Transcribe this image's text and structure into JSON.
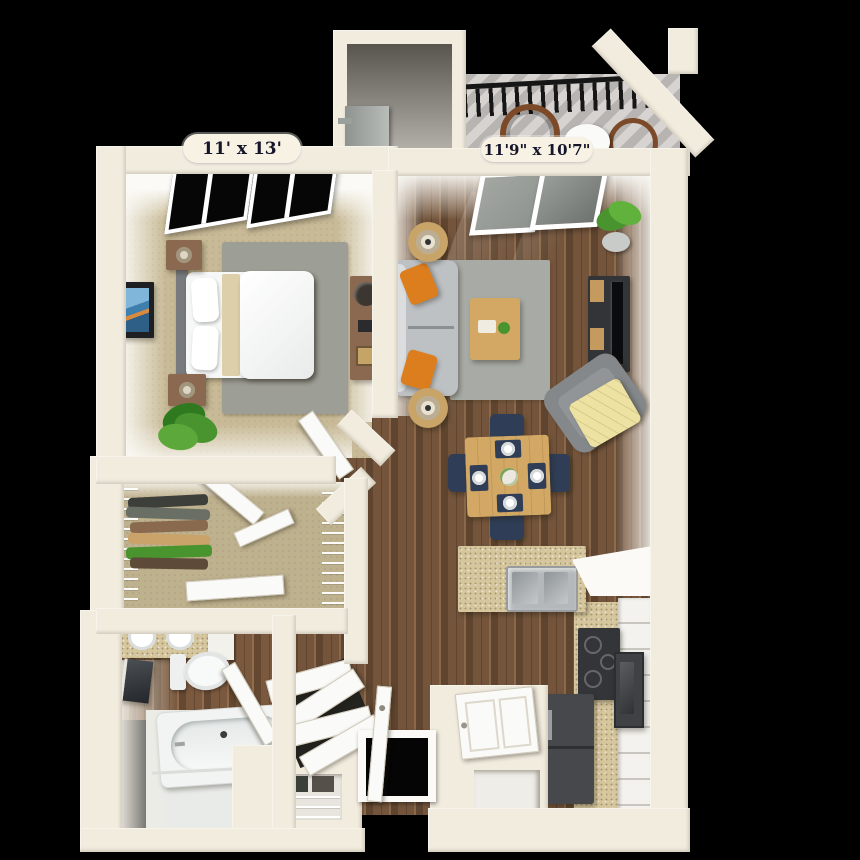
{
  "scene": {
    "description": "3D top-down rendering of a one-bedroom apartment floor plan on a black background",
    "canvas_px": "860x860"
  },
  "rooms": {
    "bedroom": {
      "dimensions_label": "11' x 13'"
    },
    "living_room": {
      "dimensions_label": "11'9\" x 10'7\""
    }
  },
  "colors": {
    "bg": "#000000",
    "wall": "#f2ecdf",
    "wallEdge": "#d9d2c0",
    "white": "#fafaf8",
    "wood": "#74553c",
    "woodDark": "#5f452f",
    "woodLight": "#8a6849",
    "carpet": "#c8ba96",
    "rug": "#9d9e96",
    "rugLiving": "#a8aba5",
    "sofa": "#bdc1c4",
    "armchair": "#84888a",
    "orange": "#dd7e1e",
    "yellow": "#eee2a2",
    "navy": "#2f3e56",
    "tableWood": "#d2a864",
    "brownFurn": "#8a6950",
    "tvDark": "#323437",
    "granite": "#d5c69d",
    "steel": "#b4b8ba",
    "fridge": "#46484b",
    "appliance": "#333538",
    "cabinet": "#f3f2ee",
    "green": "#4a9430",
    "greenDark": "#2f7a1e",
    "pot": "#c9cbc8",
    "deckA": "#d6d3d0",
    "deckB": "#b7b4b1",
    "rail": "#161616",
    "glass": "#8f938f",
    "bathFloor": "#e9ebe8",
    "alcoveDark": "#58554f",
    "alcoveLight": "#b5b1ab",
    "wheel": "#7c4a28",
    "labelBg": "#f7f2e4",
    "labelText": "#16162b"
  }
}
